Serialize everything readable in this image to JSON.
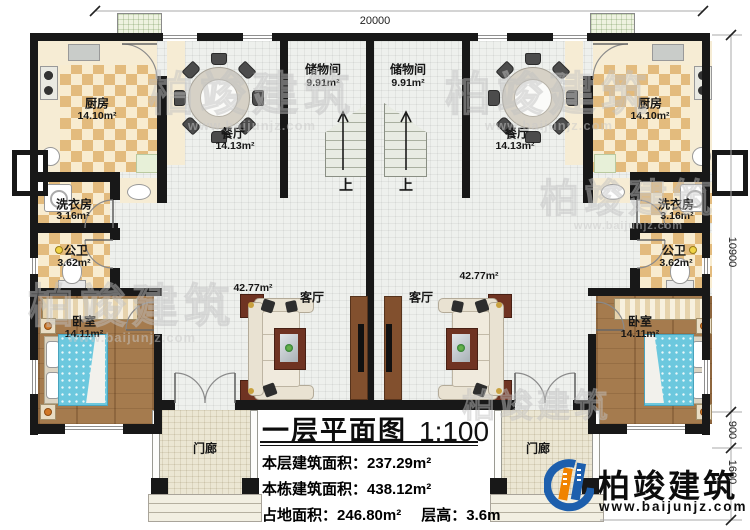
{
  "title": {
    "text": "一层平面图",
    "scale": "1:100"
  },
  "stats": {
    "rows": [
      {
        "label": "本层建筑面积：",
        "value": "237.29m²"
      },
      {
        "label": "本栋建筑面积：",
        "value": "438.12m²"
      },
      {
        "label": "占地面积：",
        "value": "246.80m²",
        "label2": "层高：",
        "value2": "3.6m"
      }
    ]
  },
  "dimensions": {
    "top": "20000",
    "right": [
      "10900",
      "900",
      "1600"
    ]
  },
  "rooms": {
    "kitchen": {
      "name": "厨房",
      "area": "14.10m²"
    },
    "dining": {
      "name": "餐厅",
      "area": "14.13m²"
    },
    "storage": {
      "name": "储物间",
      "area": "9.91m²"
    },
    "laundry": {
      "name": "洗衣房",
      "area": "3.16m²"
    },
    "bath": {
      "name": "公卫",
      "area": "3.62m²"
    },
    "bedroom": {
      "name": "卧室",
      "area": "14.11m²"
    },
    "living": {
      "name": "客厅",
      "area": "42.77m²"
    },
    "porch": {
      "name": "门廊"
    },
    "stairs_up": "上"
  },
  "brand": {
    "name": "柏竣建筑",
    "url": "www.baijunjz.com"
  },
  "watermark": {
    "text": "柏竣建筑",
    "url": "www.baijunjz.com"
  },
  "colors": {
    "brand_blue": "#1d5fad",
    "brand_orange": "#f08300",
    "wall": "#181818"
  }
}
